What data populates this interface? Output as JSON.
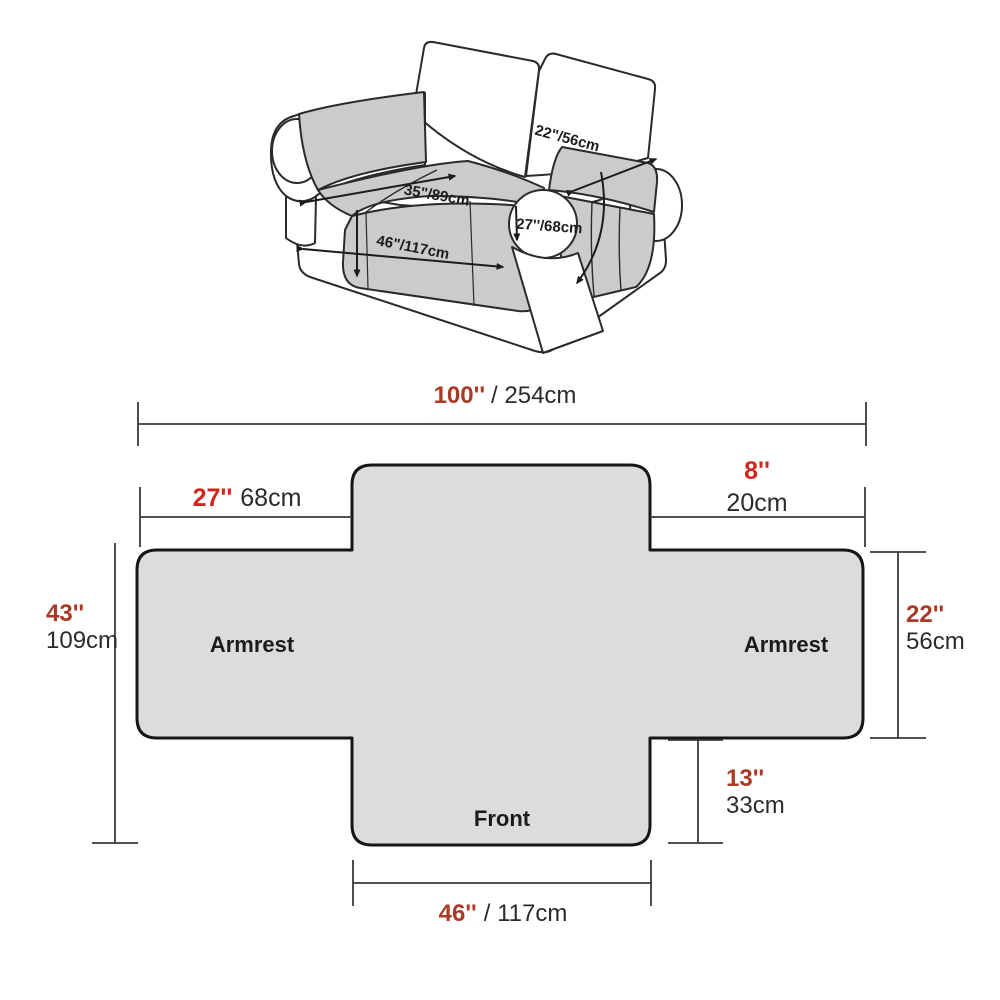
{
  "colors": {
    "inch_red_brick": "#aa3a26",
    "inch_red_bright": "#d2261d",
    "dim_text_dark": "#2b2b2b",
    "cover_gray": "#dcdcdc",
    "sofa_cover_gray": "#cbcbcb",
    "outline_dark": "#1f1f1f"
  },
  "sofa": {
    "back_cushion_dim": "22\"/56cm",
    "seat_back_dim": "35\"/89cm",
    "seat_front_dim": "46\"/117cm",
    "armrest_dim": "27''/68cm"
  },
  "cover": {
    "armrest_left": "Armrest",
    "armrest_right": "Armrest",
    "front": "Front"
  },
  "dims": {
    "total": {
      "in": "100''",
      "cm": "/ 254cm"
    },
    "back_left": {
      "in": "27''",
      "cm": "68cm"
    },
    "back_right": {
      "in": "8''",
      "cm": "20cm"
    },
    "side_left": {
      "in": "43''",
      "cm": "109cm"
    },
    "side_right": {
      "in": "22''",
      "cm": "56cm"
    },
    "front_drop": {
      "in": "13''",
      "cm": "33cm"
    },
    "front_width": {
      "in": "46''",
      "cm": "/ 117cm"
    }
  }
}
